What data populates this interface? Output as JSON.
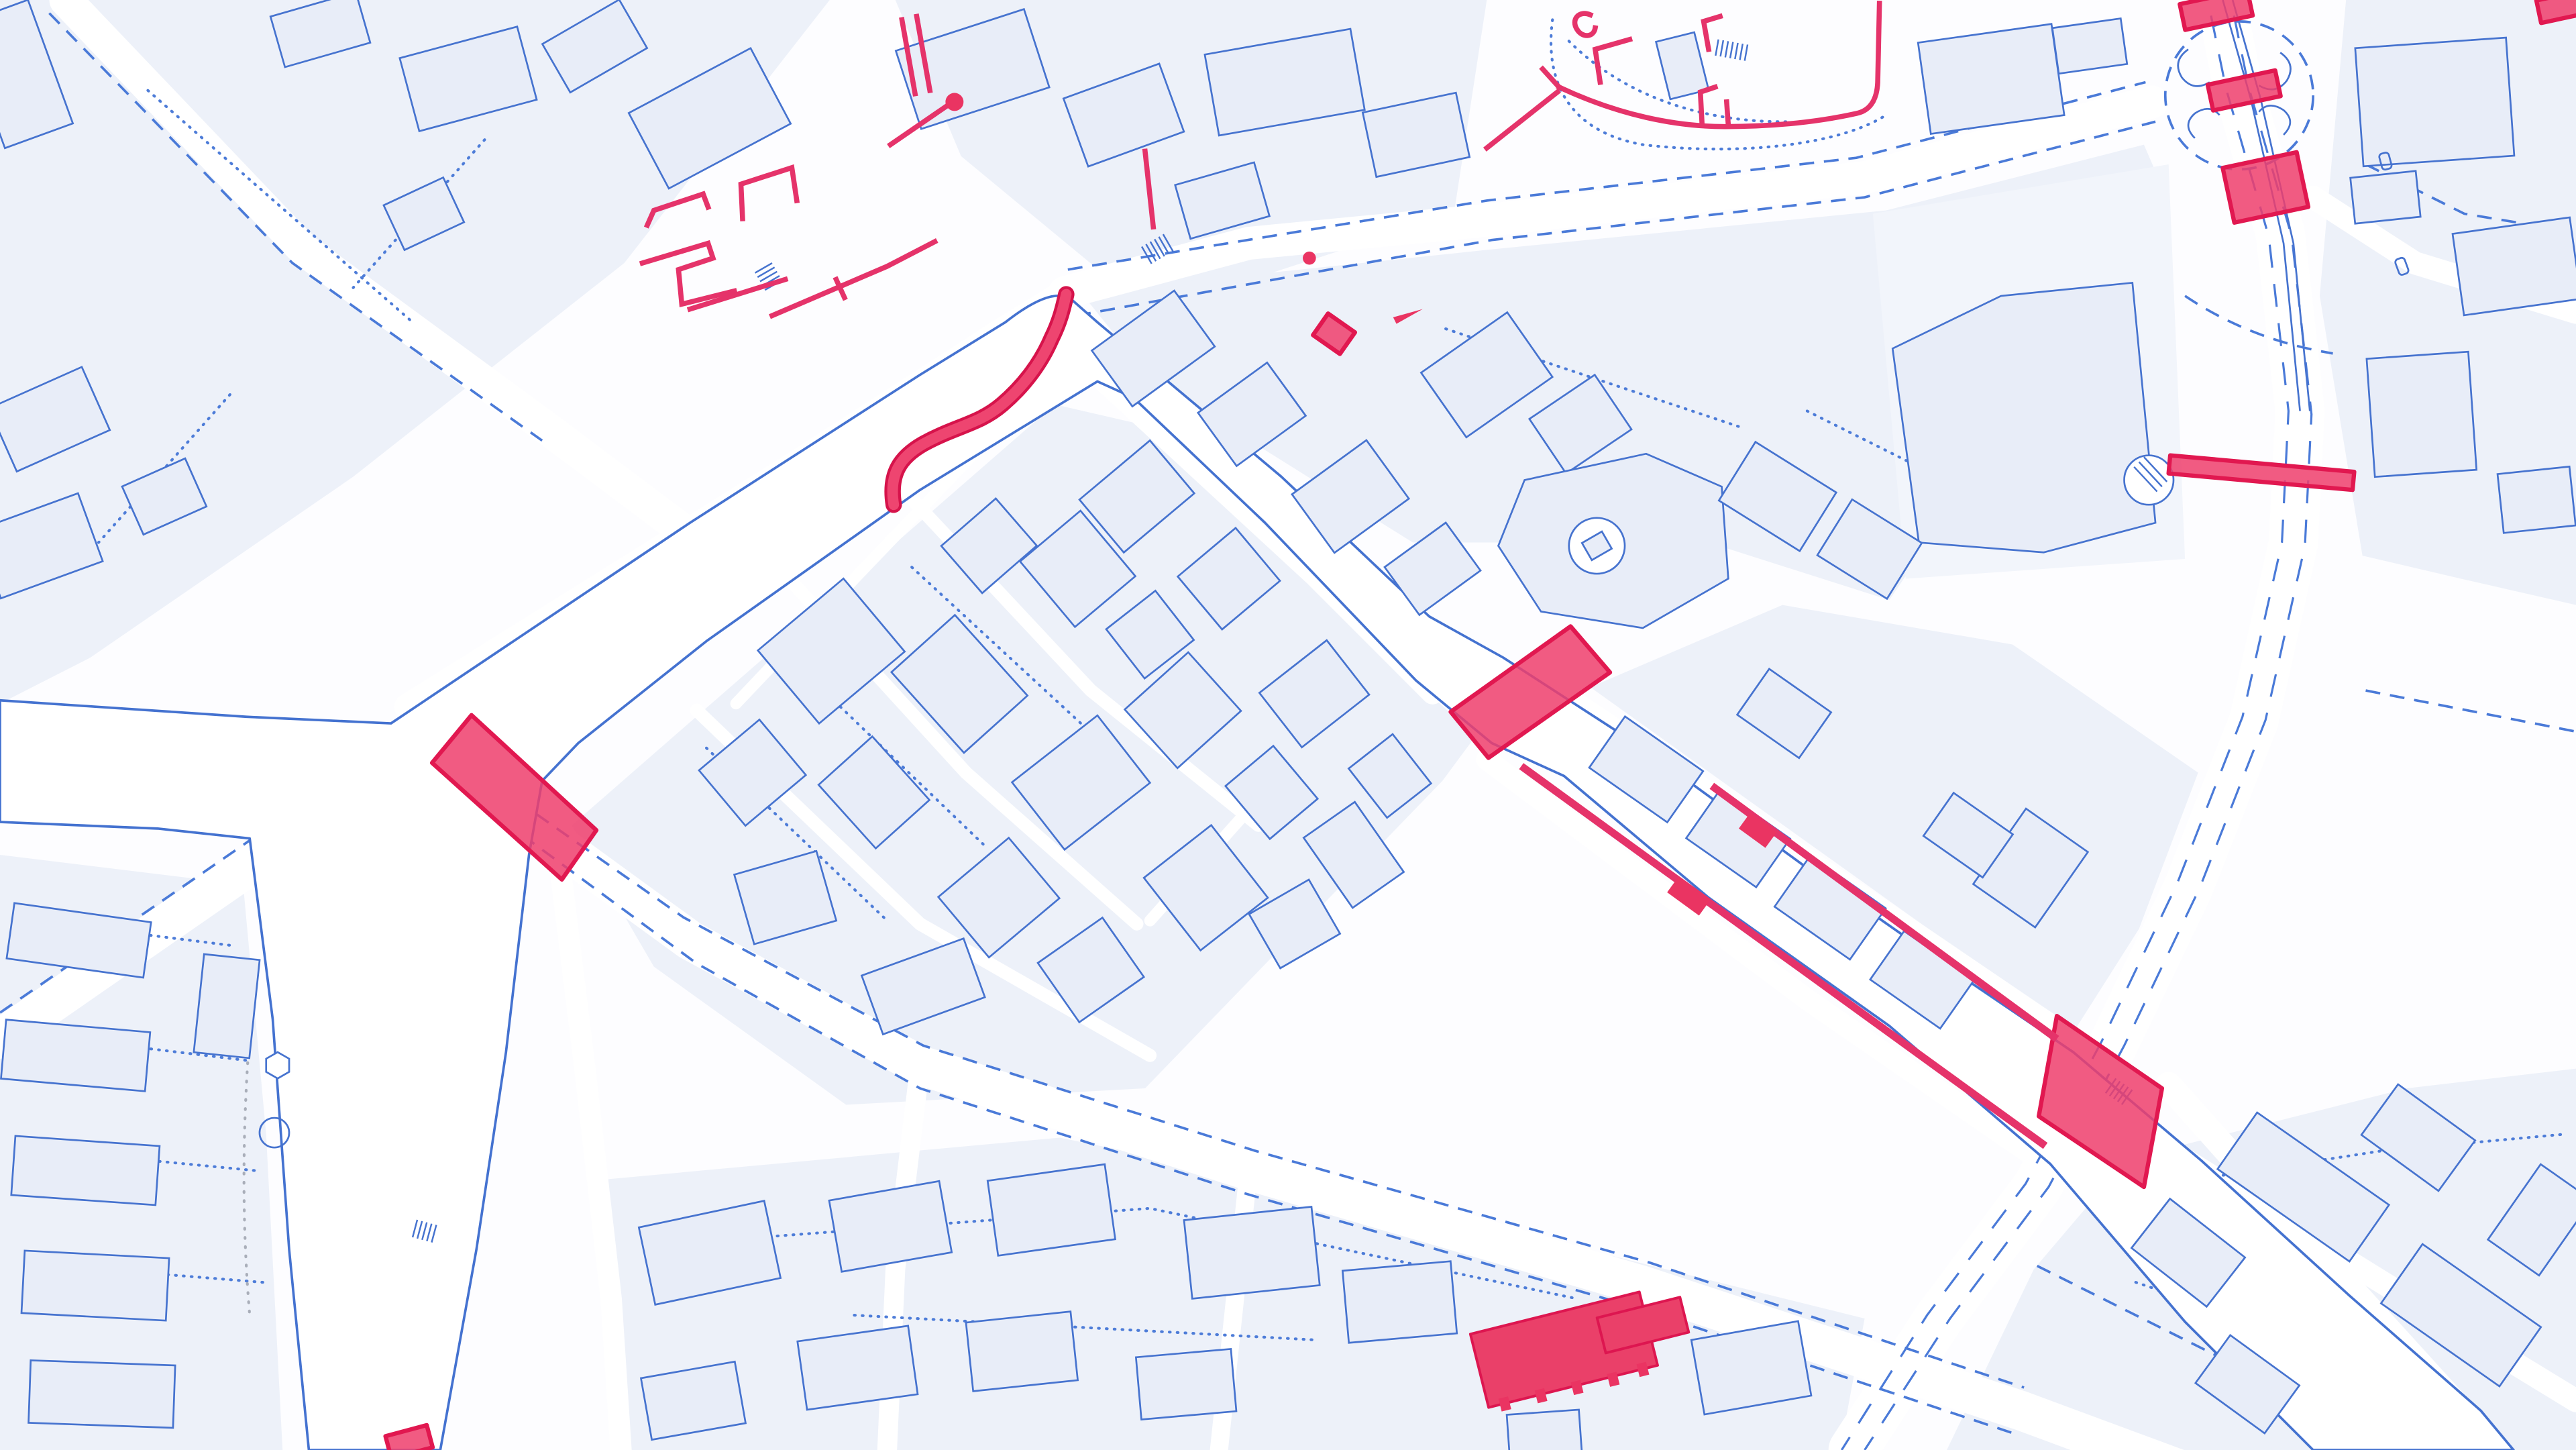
{
  "page": {
    "title": "City base map — highlighted heritage features"
  },
  "map": {
    "aria_label": "Blueprint-style monochrome city map with buildings outlined in blue and heritage features highlighted in pink",
    "style": "blueprint-vector",
    "palette": {
      "background": "#fdfdff",
      "parcel_fill": "#edf1f9",
      "building_fill": "#e8edf8",
      "line_blue": "#4673cf",
      "dashed_blue": "#4a7ad8",
      "dotted_blue": "#4d7cd8",
      "dotted_gray": "#a9aeb9",
      "water_fill": "#ffffff",
      "highlight_pink": "#ee3e6c",
      "highlight_border": "#e11850"
    },
    "highlights": [
      {
        "id": "weir-curve",
        "label": "Curved weir crossing"
      },
      {
        "id": "west-bridge",
        "label": "West river bridge"
      },
      {
        "id": "central-bridge",
        "label": "Central river bridge"
      },
      {
        "id": "road-river-bridge",
        "label": "Road-over-river bridge"
      },
      {
        "id": "south-quay-wall",
        "label": "South quay wall"
      },
      {
        "id": "north-quay-wall",
        "label": "North quay wall"
      },
      {
        "id": "rail-crossing-north",
        "label": "Rail crossing (north)"
      },
      {
        "id": "rail-crossing-middle",
        "label": "Rail crossing (middle)"
      },
      {
        "id": "rail-crossing-south",
        "label": "Rail crossing (south)"
      },
      {
        "id": "footbridge",
        "label": "Footbridge over carriageway"
      },
      {
        "id": "highlighted-building",
        "label": "Highlighted building"
      },
      {
        "id": "city-wall-west",
        "label": "City wall remains (west)"
      },
      {
        "id": "walled-enclosure-east",
        "label": "Walled enclosure (east)"
      },
      {
        "id": "tower-marker",
        "label": "Tower marker"
      },
      {
        "id": "channel-bridge-small",
        "label": "Small channel bridge"
      },
      {
        "id": "south-channel-bridge",
        "label": "South channel bridge"
      }
    ],
    "counts": {
      "highlighted_features": 16
    }
  }
}
